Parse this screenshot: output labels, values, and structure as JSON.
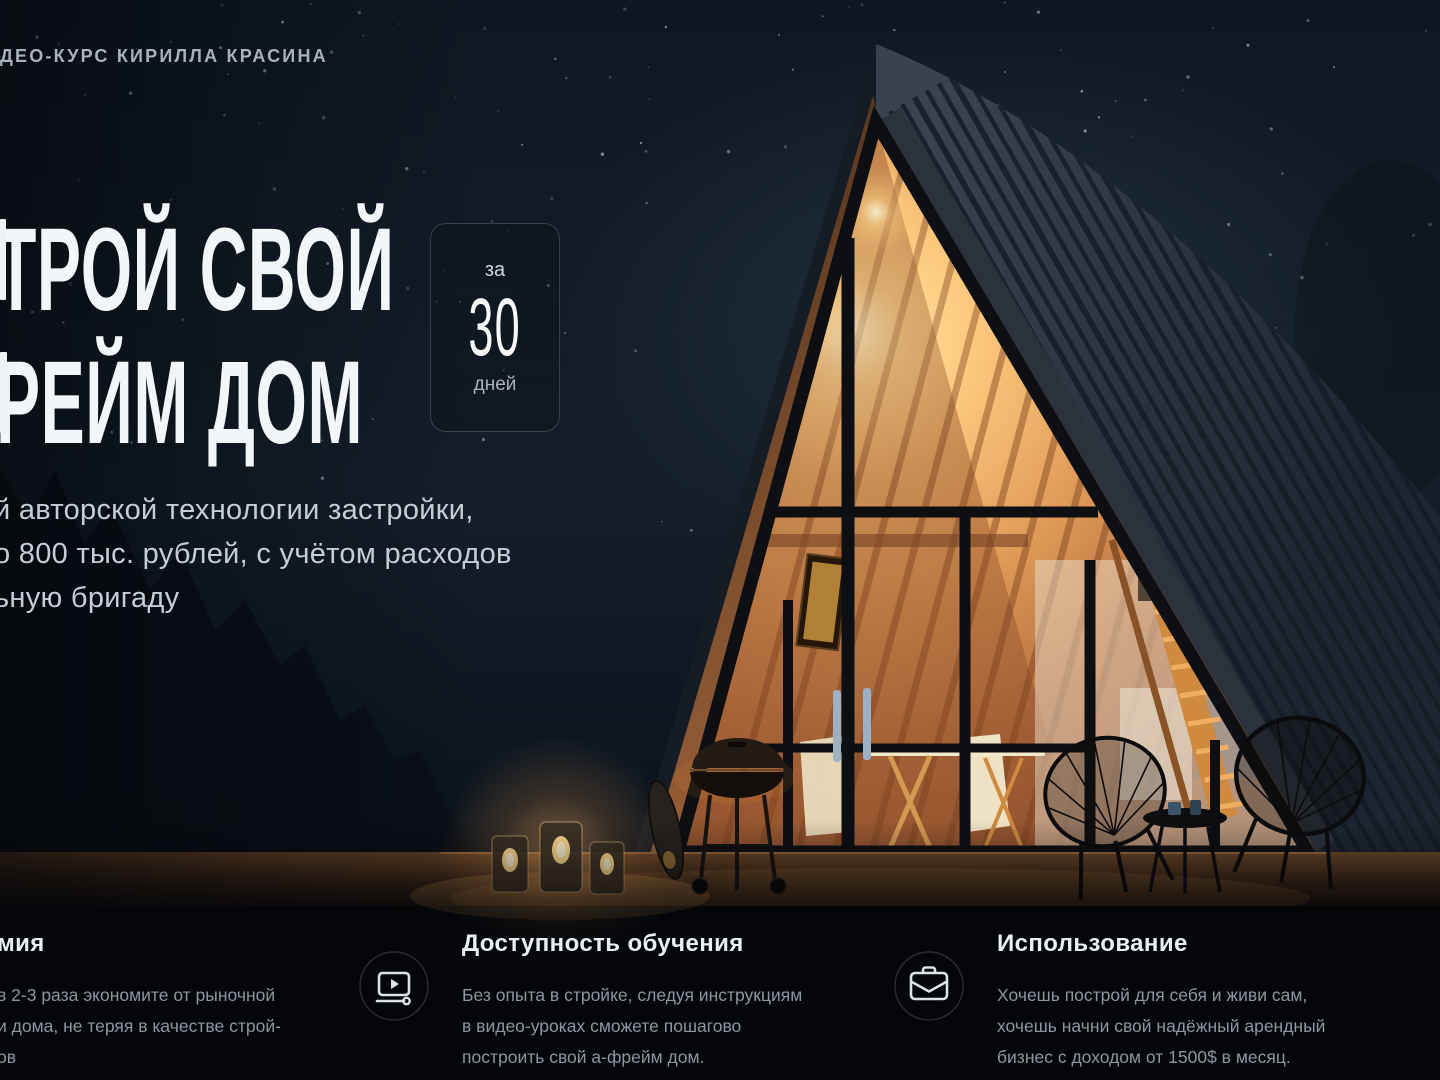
{
  "page": {
    "top_label": "ДЕО-КУРС КИРИЛЛА КРАСИНА",
    "title_line1": "ТРОЙ СВОЙ",
    "title_line2": "РЕЙМ ДОМ",
    "badge": {
      "prefix": "за",
      "number": "30",
      "suffix": "дней"
    },
    "intro_lines": [
      "й авторской технологии застройки,",
      "о 800 тыс. рублей, с учётом расходов",
      "ьную бригаду"
    ]
  },
  "features": [
    {
      "title": "мия",
      "icon": null,
      "lines": [
        "в 2-3 раза экономите от рыночной",
        "и дома, не теряя в качестве строй-",
        "ов"
      ]
    },
    {
      "title": "Доступность обучения",
      "icon": "video-player-icon",
      "lines": [
        "Без опыта в стройке, следуя инструкциям",
        "в видео-уроках сможете пошагово",
        "построить свой а-фрейм дом."
      ]
    },
    {
      "title": "Использование",
      "icon": "briefcase-icon",
      "lines": [
        "Хочешь построй для себя и живи сам,",
        "хочешь начни свой надёжный арендный",
        "бизнес с доходом от 1500$ в месяц."
      ]
    }
  ],
  "colors": {
    "sky_top": "#0f1822",
    "sky_bottom": "#060a10",
    "roof_dark": "#232e39",
    "interior_glow": "#ffe7ae",
    "wood_warm": "#c07848",
    "text_primary": "#f3f6f8",
    "text_secondary": "#c5ced6",
    "text_muted": "#8d97a1",
    "badge_border": "rgba(150,175,185,0.28)"
  }
}
